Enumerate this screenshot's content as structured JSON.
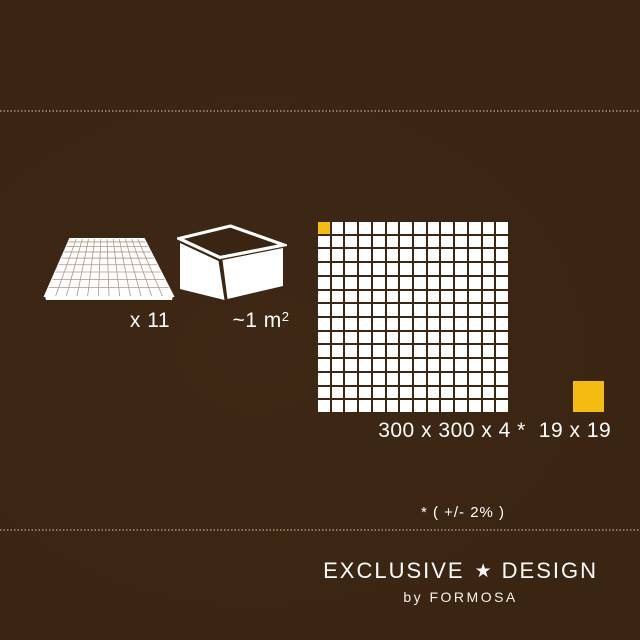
{
  "colors": {
    "background": "#3A2412",
    "accent": "#F4BB13",
    "tile": "#FFFFFF",
    "dot_line": "#9B8670",
    "text": "#FFFFFF"
  },
  "sheet_icon": {
    "name": "mosaic-sheet-icon",
    "label": "x 11"
  },
  "box_icon": {
    "name": "box-icon",
    "label_base": "~1 m",
    "label_sup": "2"
  },
  "mosaic": {
    "rows": 14,
    "cols": 14,
    "label": "300 x 300 x 4 *",
    "accent_tile_position": "top-left"
  },
  "chip": {
    "label": "19 x 19"
  },
  "note": "* ( +/- 2% )",
  "brand": {
    "title_left": "EXCLUSIVE",
    "star": "★",
    "title_right": "DESIGN",
    "subtitle": "by FORMOSA"
  }
}
